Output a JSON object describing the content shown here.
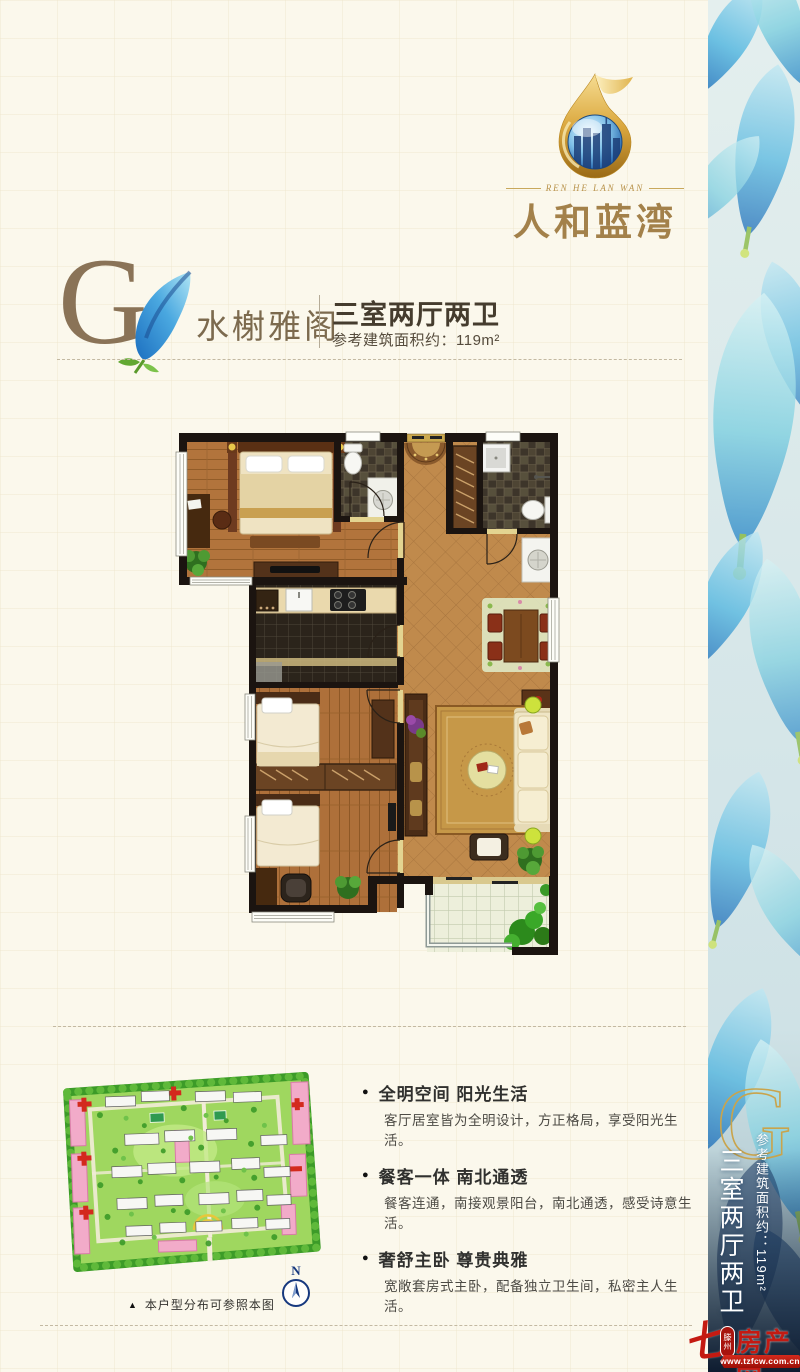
{
  "logo": {
    "english": "REN HE LAN WAN",
    "chinese": "人和蓝湾"
  },
  "header": {
    "letter": "G",
    "name": "水榭雅阁",
    "spec": "三室两厅两卫",
    "area": "参考建筑面积约：119m²"
  },
  "features": {
    "bullet": "●",
    "items": [
      {
        "title": "全明空间 阳光生活",
        "desc": "客厅居室皆为全明设计，方正格局，享受阳光生活。"
      },
      {
        "title": "餐客一体 南北通透",
        "desc": "餐客连通，南接观景阳台，南北通透，感受诗意生活。"
      },
      {
        "title": "奢舒主卧 尊贵典雅",
        "desc": "宽敞套房式主卧，配备独立卫生间，私密主人生活。"
      }
    ]
  },
  "site_plan": {
    "marker": "▲",
    "caption": "本户型分布可参照本图",
    "compass": "N"
  },
  "sidebar": {
    "letter": "G",
    "area": "参考建筑面积约：119m²",
    "spec": "三室两厅两卫"
  },
  "watermark": {
    "swoosh_glyph": "七",
    "badge": "滕州",
    "name": "房产网",
    "url": "www.tzfcw.com.cn"
  },
  "colors": {
    "cream_bg": "#fbf8ec",
    "gold_accent": "#c9a44c",
    "title_brown": "#8a7357",
    "text_dark": "#453c2e",
    "watermark_red": "#c41a12",
    "petal_blue": "#3a93d4"
  }
}
